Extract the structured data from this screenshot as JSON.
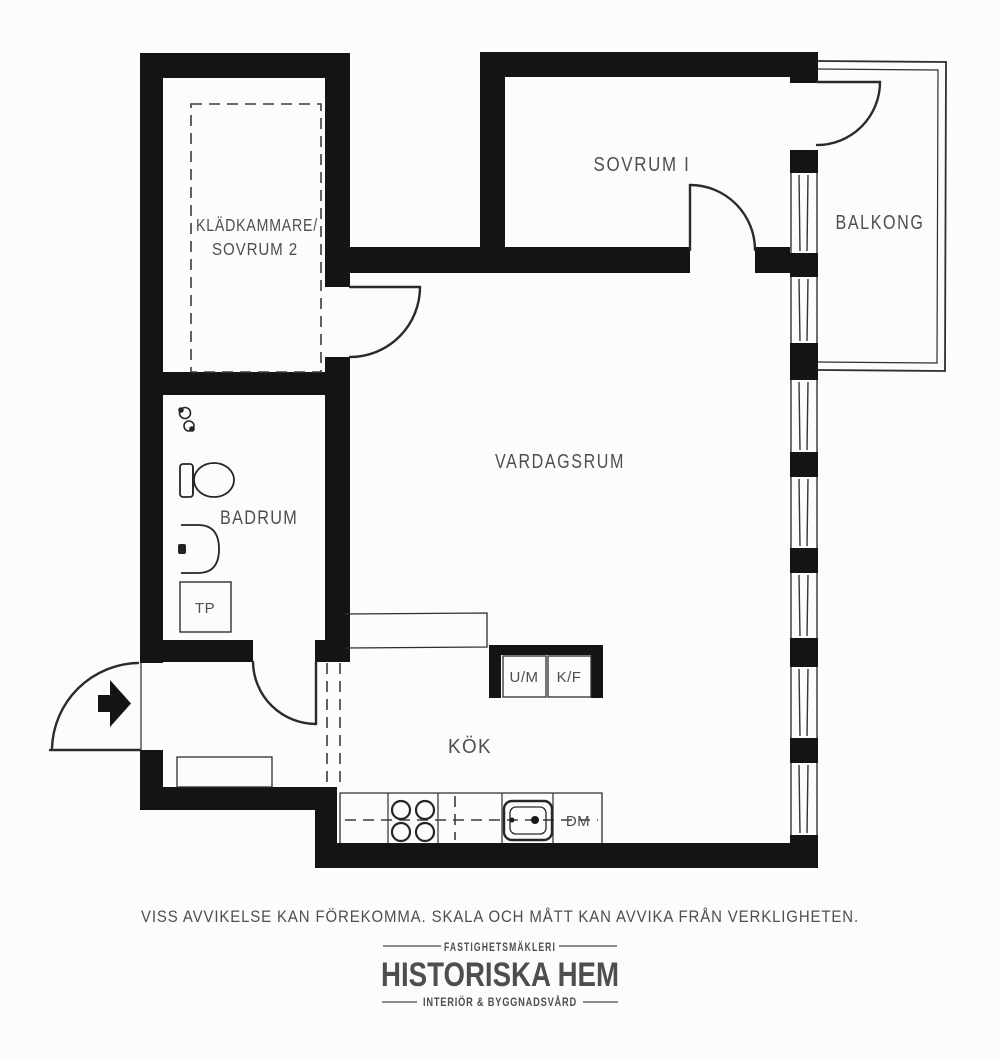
{
  "plan": {
    "rooms": {
      "kladkammare_line1": "KLÄDKAMMARE/",
      "kladkammare_line2": "SOVRUM 2",
      "sovrum1": "SOVRUM I",
      "balkong": "BALKONG",
      "vardagsrum": "VARDAGSRUM",
      "badrum": "BADRUM",
      "kok": "KÖK"
    },
    "fixtures": {
      "tp": "TP",
      "um": "U/M",
      "kf": "K/F",
      "dm": "DM"
    },
    "colors": {
      "wall": "#141414",
      "label": "#4e4e4e",
      "background": "#fcfcfb"
    }
  },
  "footer": {
    "disclaimer": "VISS AVVIKELSE KAN FÖREKOMMA. SKALA OCH MÅTT KAN AVVIKA FRÅN VERKLIGHETEN.",
    "brand_category": "FASTIGHETSMÄKLERI",
    "brand_name": "HISTORISKA HEM",
    "brand_tagline": "INTERIÖR & BYGGNADSVÅRD"
  }
}
